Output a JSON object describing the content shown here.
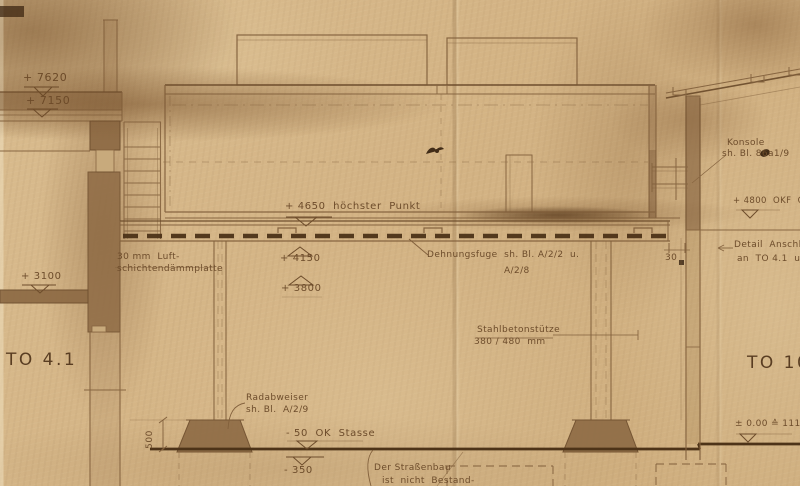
{
  "colors": {
    "paper": "#d4b586",
    "ink": "#6d4c2b",
    "ink_dark": "#593d22",
    "line": "#82603c",
    "line_dark": "#6b4b2b",
    "poche": "#8d6a44",
    "heavy_dash": "#4d3318"
  },
  "drawing": {
    "left_building": {
      "elev_7620": "+ 7620",
      "elev_7150": "+ 7150",
      "elev_3100": "+ 3100",
      "room_label": "TO 4.1",
      "insulation_note_l1": "30 mm  Luft-",
      "insulation_note_l2": "schichtendämmplatte"
    },
    "hall": {
      "elev_high_point": "+ 4650  höchster  Punkt",
      "elev_4150": "+ 4150",
      "elev_3800": "+ 3800",
      "expansion_joint_l1": "Dehnungsfuge  sh. Bl. A/2/2  u.",
      "expansion_joint_l2": "A/2/8"
    },
    "column": {
      "note_l1": "Stahlbetonstütze",
      "note_l2": "380 / 480  mm"
    },
    "street": {
      "wheel_guard_l1": "Radabweiser",
      "wheel_guard_l2": "sh. Bl.  A/2/9",
      "street_level": "- 50  OK  Stasse",
      "level_minus_350": "- 350",
      "street_note_l1": "Der Straßenbau",
      "street_note_l2": "ist  nicht  Bestand-",
      "dim_500": "500"
    },
    "right_building": {
      "console_l1": "Konsole",
      "console_l2": "sh. Bl. 86a1/9",
      "elev_4800": "+ 4800  OKF  OG",
      "detail_note_l1": "Detail  Anschlu",
      "detail_note_l2": "an  TO 4.1  u.  TO",
      "room_label": "TO 10",
      "elev_zero": "± 0.00 ≙ 111.00",
      "dim_30": "30"
    }
  }
}
